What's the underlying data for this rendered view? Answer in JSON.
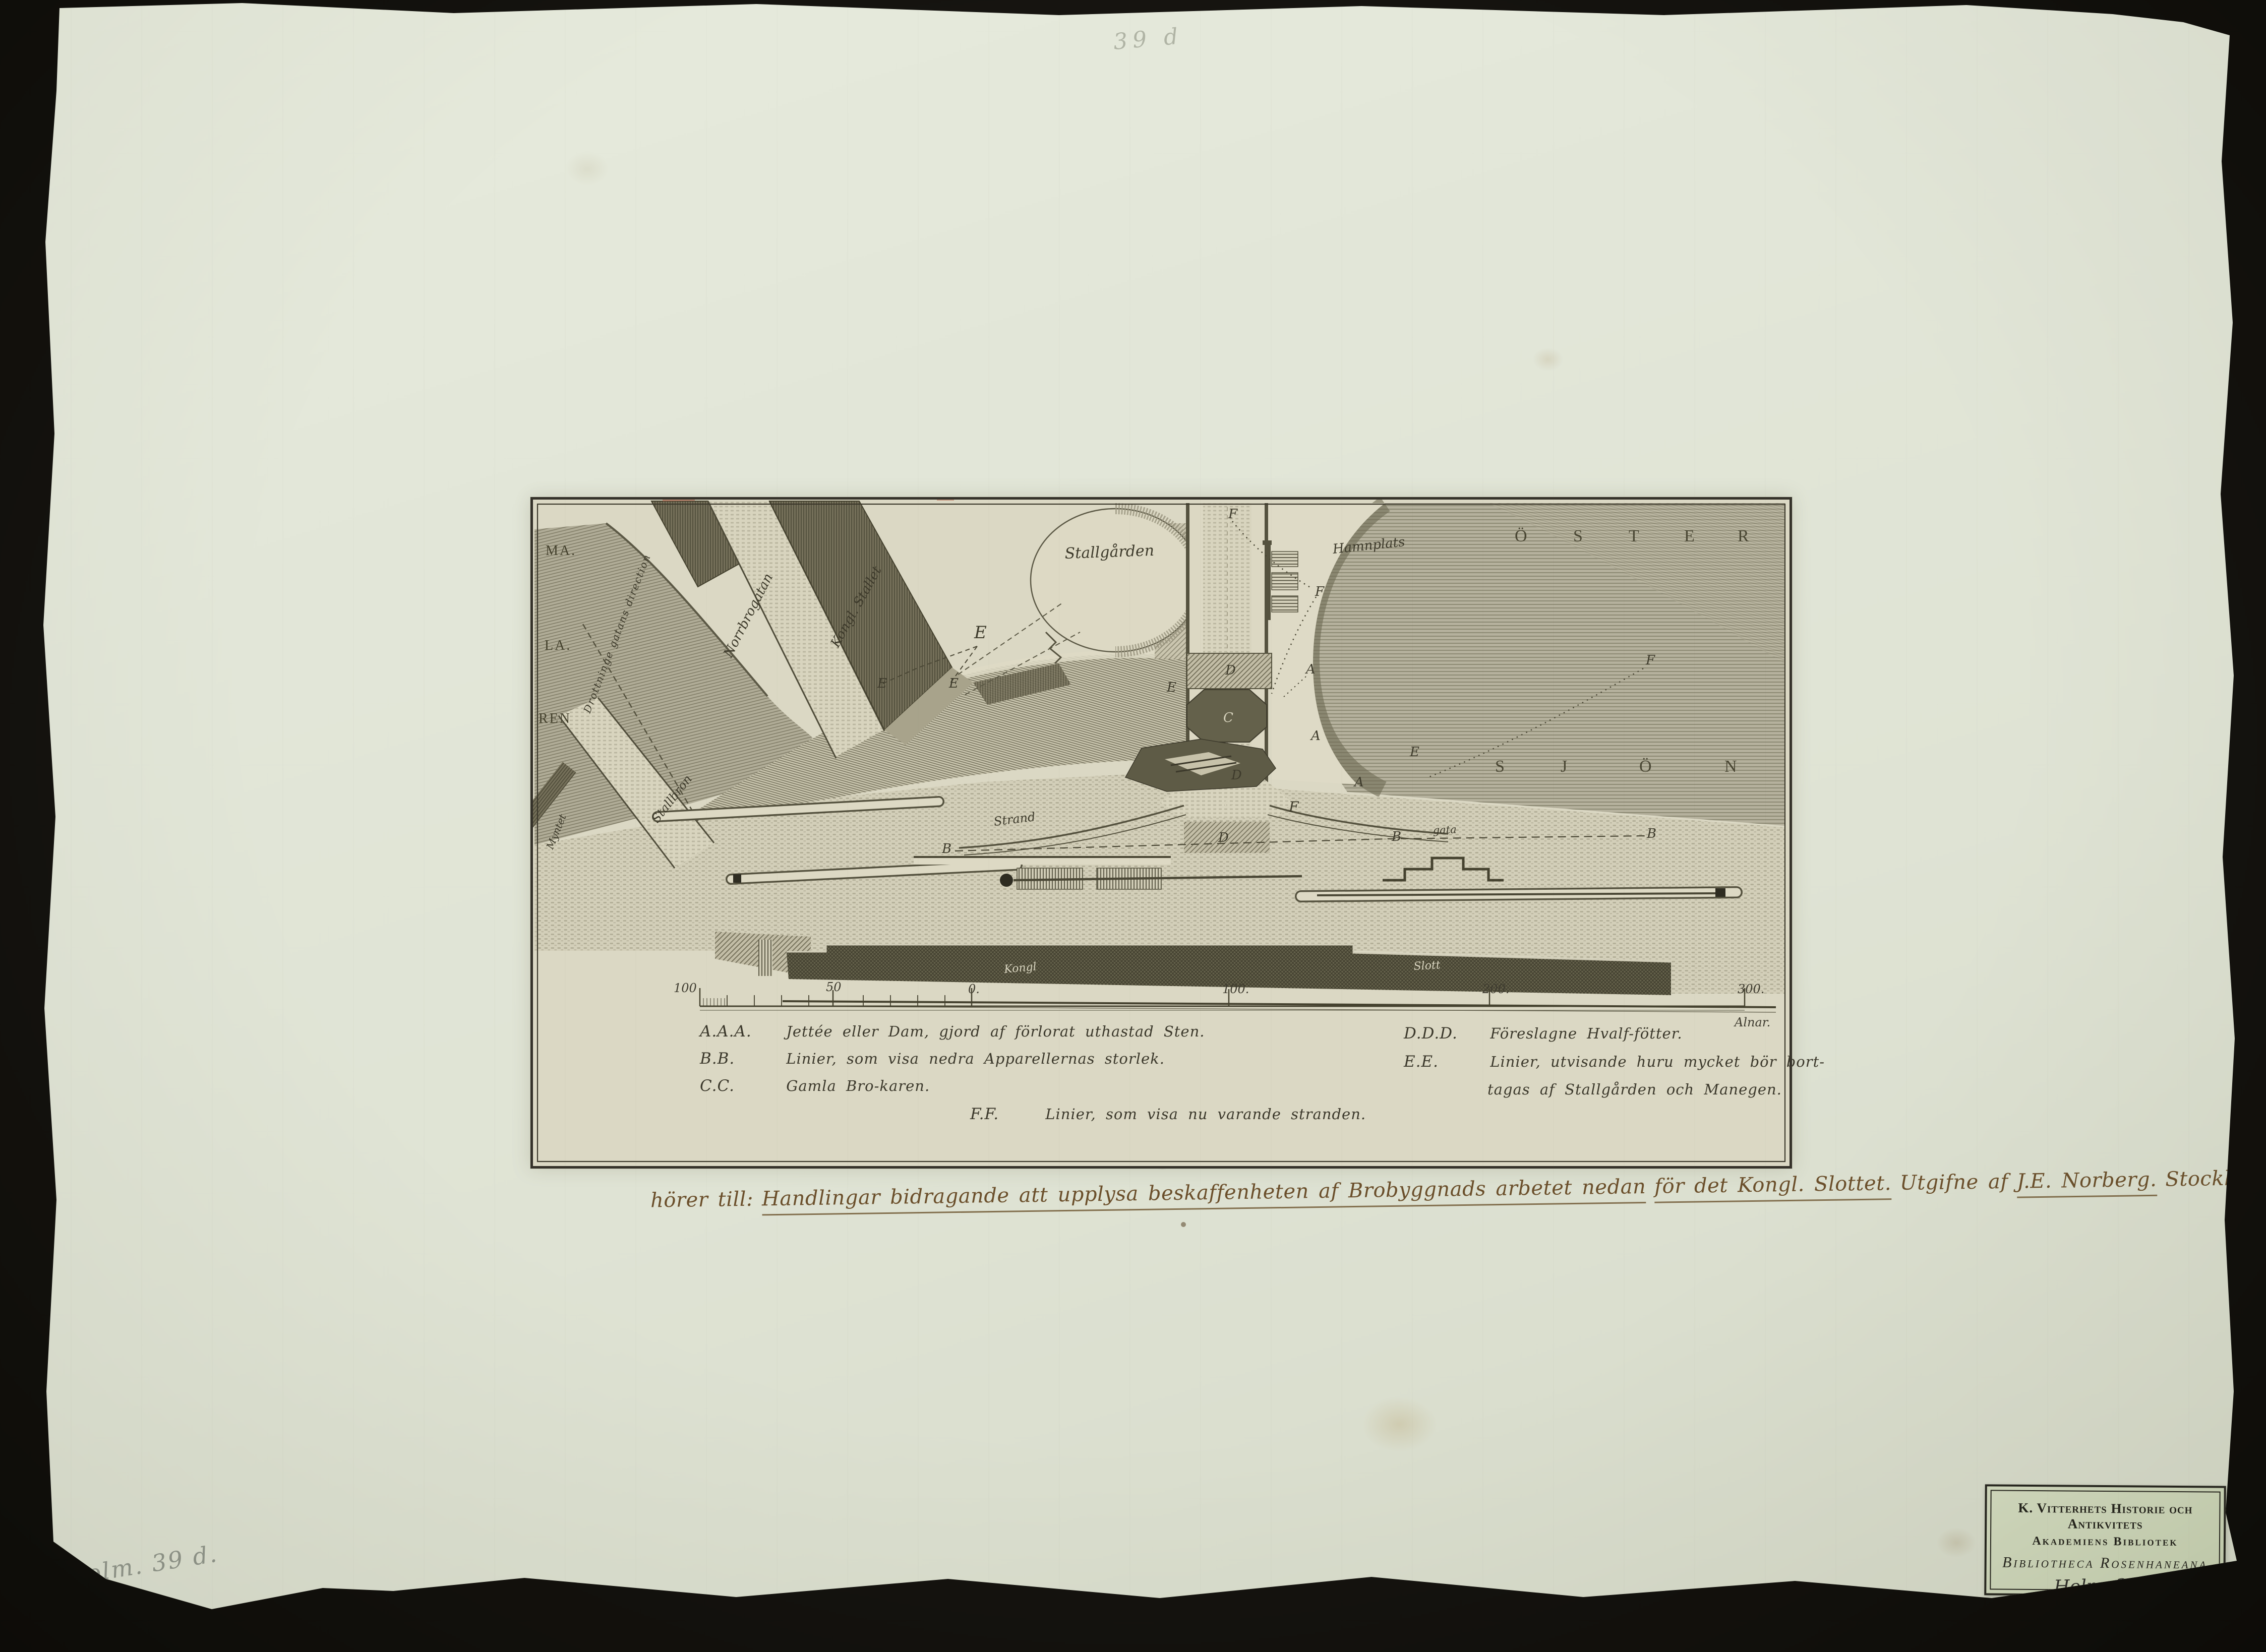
{
  "page": {
    "background": "#171510",
    "paper_color": "#e2e6d8"
  },
  "pencil_notes": {
    "top": "39 d",
    "bottom_left": "Holm. 39 d."
  },
  "plate": {
    "map": {
      "labels": {
        "stallgarden": "Stallgården",
        "hamnplats": "Hamnplats",
        "norrbrogatan": "Norrbrogatan",
        "kongl_stallet": "Kongl. Stallet",
        "stallbron": "Stallbron",
        "drottninggatan": "Drottninge gatans direction",
        "myntet": "Myntet",
        "strand": "Strand",
        "gata": "gata",
        "kongl": "Kongl",
        "slott": "Slott"
      },
      "malaren": [
        "MA.",
        "LA.",
        "REN"
      ],
      "ostersjon_top": [
        "Ö",
        "S",
        "T",
        "E",
        "R"
      ],
      "ostersjon_bottom": [
        "S",
        "J",
        "Ö",
        "N"
      ],
      "letters": [
        {
          "t": "E"
        },
        {
          "t": "E"
        },
        {
          "t": "E"
        },
        {
          "t": "E"
        },
        {
          "t": "E"
        },
        {
          "t": "F"
        },
        {
          "t": "F"
        },
        {
          "t": "F"
        },
        {
          "t": "F"
        },
        {
          "t": "A"
        },
        {
          "t": "A"
        },
        {
          "t": "A"
        },
        {
          "t": "B"
        },
        {
          "t": "B"
        },
        {
          "t": "B"
        },
        {
          "t": "C"
        },
        {
          "t": "C"
        },
        {
          "t": "D"
        },
        {
          "t": "D"
        },
        {
          "t": "D"
        }
      ]
    },
    "scale_bar": {
      "labels": [
        "100",
        "50",
        "0.",
        "100.",
        "200.",
        "300."
      ],
      "unit": "Alnar."
    },
    "legend": {
      "left": [
        {
          "key": "A.A.A.",
          "text": "Jettée eller Dam, gjord af förlorat uthastad Sten."
        },
        {
          "key": "B.B.",
          "text": "Linier, som visa nedra Apparellernas storlek."
        },
        {
          "key": "C.C.",
          "text": "Gamla Bro-karen."
        }
      ],
      "right": [
        {
          "key": "D.D.D.",
          "text": "Föreslagne Hvalf-fötter."
        },
        {
          "key": "E.E.",
          "text": "Linier, utvisande huru mycket bör bort-"
        },
        {
          "key": "",
          "text": "tagas af Stallgården och Manegen."
        }
      ],
      "center": {
        "key": "F.F.",
        "text": "Linier, som visa nu varande stranden."
      }
    }
  },
  "caption": {
    "segments": [
      {
        "text": "hörer till:"
      },
      {
        "text": "Handlingar bidragande att upplysa beskaffenheten af Brobyggnads arbetet nedan"
      },
      {
        "text": "för det Kongl. Slottet."
      },
      {
        "text": "Utgifne af"
      },
      {
        "text": "J.E. Norberg."
      },
      {
        "text": "Stockh. 1799."
      },
      {
        "text": "4to."
      }
    ]
  },
  "library_label": {
    "line1": "K. Vitterhets Historie och Antikvitets",
    "line2": "Akademiens Bibliotek",
    "line3": "Bibliotheca Rosenhaneana",
    "shelfmark": "Holm. 39 d"
  }
}
